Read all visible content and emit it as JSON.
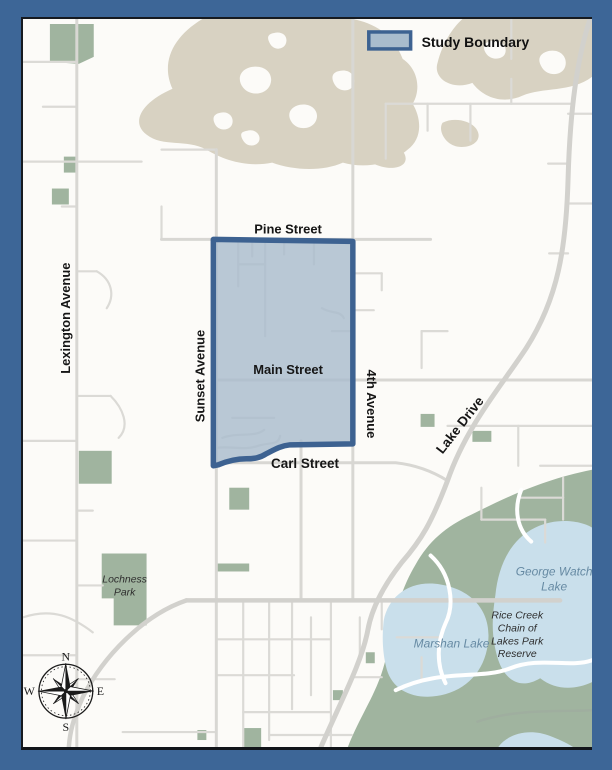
{
  "legend": {
    "label": "Study Boundary"
  },
  "streets": {
    "pine": "Pine Street",
    "main": "Main Street",
    "carl": "Carl Street",
    "lexington": "Lexington Avenue",
    "sunset": "Sunset Avenue",
    "fourth": "4th Avenue",
    "lake_drive": "Lake Drive"
  },
  "parks": {
    "lochness": [
      "Lochness",
      "Park"
    ],
    "rice_creek": [
      "Rice Creek",
      "Chain of",
      "Lakes Park",
      "Reserve"
    ]
  },
  "lakes": {
    "marshan": "Marshan Lake",
    "george_watch": [
      "George Watch",
      "Lake"
    ]
  },
  "compass": {
    "n": "N",
    "e": "E",
    "s": "S",
    "w": "W"
  },
  "colors": {
    "frame": "#3d6697",
    "boundary_stroke": "#3d6291",
    "boundary_fill": "#a9bccd",
    "water": "#c9dfeb",
    "parkland": "#a0b49f",
    "wetland": "#d8d2c2",
    "road": "#dbdad6",
    "lake_label": "#668aa3"
  }
}
